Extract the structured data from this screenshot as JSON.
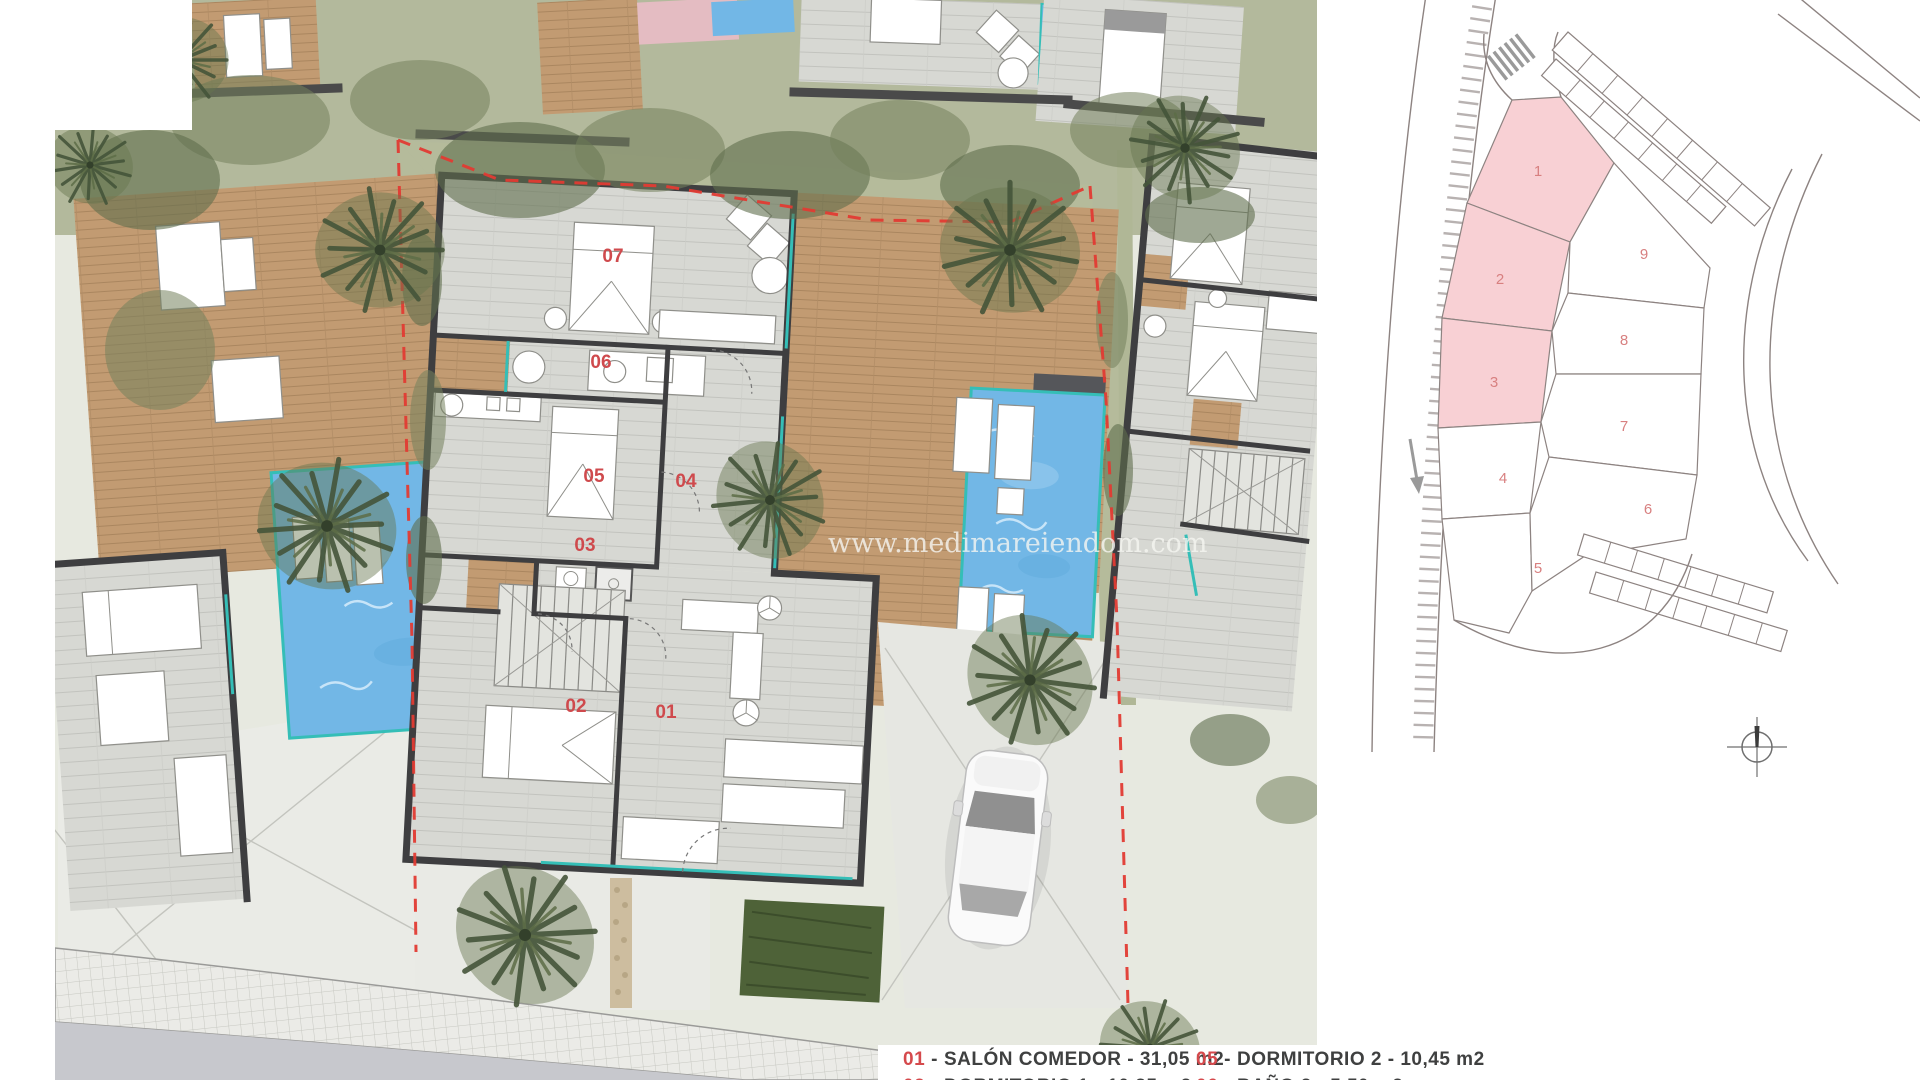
{
  "watermark": "www.medimareiendom.com",
  "plan": {
    "rooms": [
      "01",
      "02",
      "03",
      "04",
      "05",
      "06",
      "07"
    ]
  },
  "legend": {
    "separator": "-",
    "items": [
      {
        "num": "01",
        "text": "SALÓN COMEDOR - 31,05 m2"
      },
      {
        "num": "02",
        "text": "DORMITORIO 1 - 10,35 m2"
      },
      {
        "num": "05",
        "text": "DORMITORIO 2 - 10,45 m2"
      },
      {
        "num": "06",
        "text": "BAÑO 2 - 5,50 m2"
      }
    ]
  },
  "site_plan": {
    "plots": [
      {
        "id": "1",
        "highlighted": true
      },
      {
        "id": "2",
        "highlighted": true
      },
      {
        "id": "3",
        "highlighted": true
      },
      {
        "id": "4",
        "highlighted": false
      },
      {
        "id": "5",
        "highlighted": false
      },
      {
        "id": "6",
        "highlighted": false
      },
      {
        "id": "7",
        "highlighted": false
      },
      {
        "id": "8",
        "highlighted": false
      },
      {
        "id": "9",
        "highlighted": false
      }
    ],
    "highlight_color": "#f8d0d4",
    "line_color": "#8d8381",
    "number_color": "#d88080"
  },
  "colors": {
    "room_label_red": "#cf4a4d",
    "legend_red": "#d5494c",
    "legend_text": "#3f4040",
    "boundary_red": "#e23b33",
    "pool_blue": "#72b7e6",
    "pool_edge_teal": "#35beb7",
    "deck_wood": "#c29b72",
    "floor_gray": "#d7d8d3",
    "wall_dark": "#3e3e40",
    "grass_olive": "#b5bb9b",
    "tree_green": "#6e7d58",
    "road_gray": "#c7c8cd"
  }
}
